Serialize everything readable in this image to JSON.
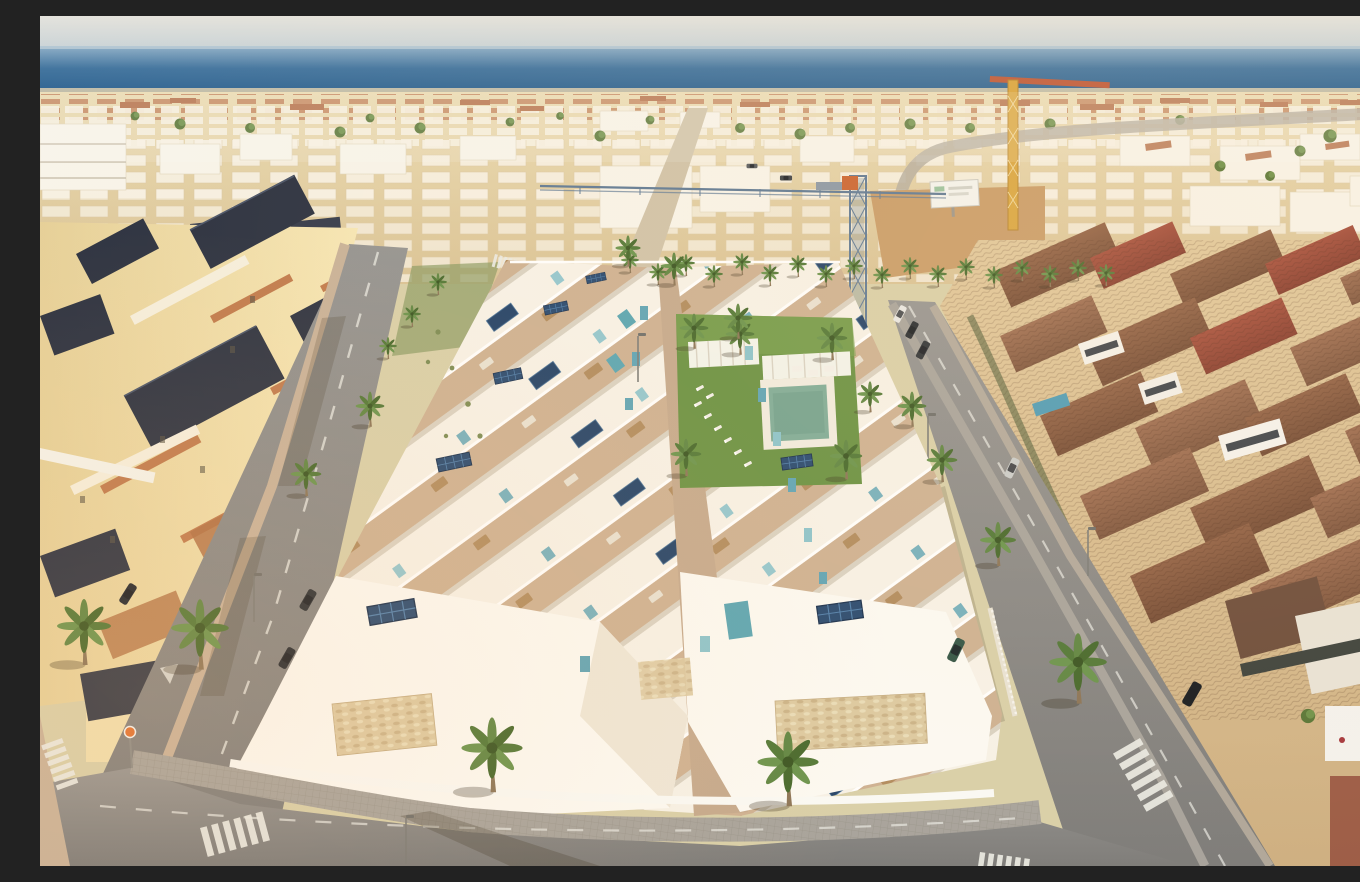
{
  "scene": {
    "description": "Aerial drone view of a coastal town: a new development of terraced white villas with rooftop solar panels, teal glass accents and a communal palm-lined lawn with swimming pool, bordered by palm-lined asphalt streets with zebra crossings and parked cars; an older neighbourhood of cream villas with dark tiled roofs on the left, terracotta-roofed houses on the right, a dense low-rise townscape with two construction cranes and a sandy vacant lot behind, and the sea at the horizon under a hazy sky.",
    "horizon": "sea",
    "lighting": "low warm sun from the upper right, long shadows toward lower left",
    "regions": [
      {
        "id": "sky",
        "label": "Hazy sky"
      },
      {
        "id": "sea",
        "label": "Sea horizon band"
      },
      {
        "id": "city-band",
        "label": "Dense low-rise townscape"
      },
      {
        "id": "construction-site",
        "label": "Sandy vacant lot with billboard"
      },
      {
        "id": "tower-crane-blue",
        "label": "Blue lattice tower crane"
      },
      {
        "id": "tower-crane-yellow",
        "label": "Yellow tower crane"
      },
      {
        "id": "left-neighbourhood",
        "label": "Cream villas with dark tiled roofs"
      },
      {
        "id": "right-neighbourhood",
        "label": "Terracotta-roofed houses"
      },
      {
        "id": "new-development",
        "label": "White terraced villas with solar panels"
      },
      {
        "id": "pool-garden",
        "label": "Communal lawn, pool, pergolas and sun loungers"
      },
      {
        "id": "streets",
        "label": "Asphalt streets with lane markings, crossings, lamps and parked cars"
      }
    ],
    "objects": {
      "palm_trees": 40,
      "parked_cars": 11,
      "construction_cranes": 2,
      "zebra_crossings": 5,
      "swimming_pools": 5,
      "solar_panel_arrays": 12,
      "billboards": 1,
      "traffic_signs": 1,
      "street_lamps": 5,
      "sun_loungers": 8,
      "pergolas": 2
    }
  },
  "palette": {
    "sky-top": "#e4e3dd",
    "sky-bottom": "#c7d2d7",
    "sea-light": "#8fb0c9",
    "sea-mid": "#41749f",
    "sea-deep": "#2c6190",
    "sand": "#c89b67",
    "city-base": "#eadbb2",
    "city-shade": "#d9c294",
    "white-building": "#f8f4ea",
    "terracotta": "#b5734e",
    "green-dark": "#49662f",
    "green-mid": "#68924a",
    "lawn": "#679040",
    "pool-water": "#7dab97",
    "plunge-pool": "#57a4b2",
    "teal-accent": "#5ca3b5",
    "solar-panel": "#24466e",
    "dev-white": "#f7f2e8",
    "terrace-floor": "#cdb091",
    "walkway": "#c4a88c",
    "stone-clad": "#dcc9a0",
    "asphalt": "#8b8a88",
    "road-marking": "#e8e8e2",
    "paver-gray": "#a6a29b",
    "paver-pink": "#c8b198",
    "left-wall": "#f2e0ac",
    "left-roof": "#2b3140",
    "right-wall": "#d9bd92",
    "roof-brown": "#8f5e42",
    "roof-red": "#a34a38",
    "crane-blue": "#5d7894",
    "crane-yellow": "#d9a53f",
    "car-dark": "#20262e"
  }
}
